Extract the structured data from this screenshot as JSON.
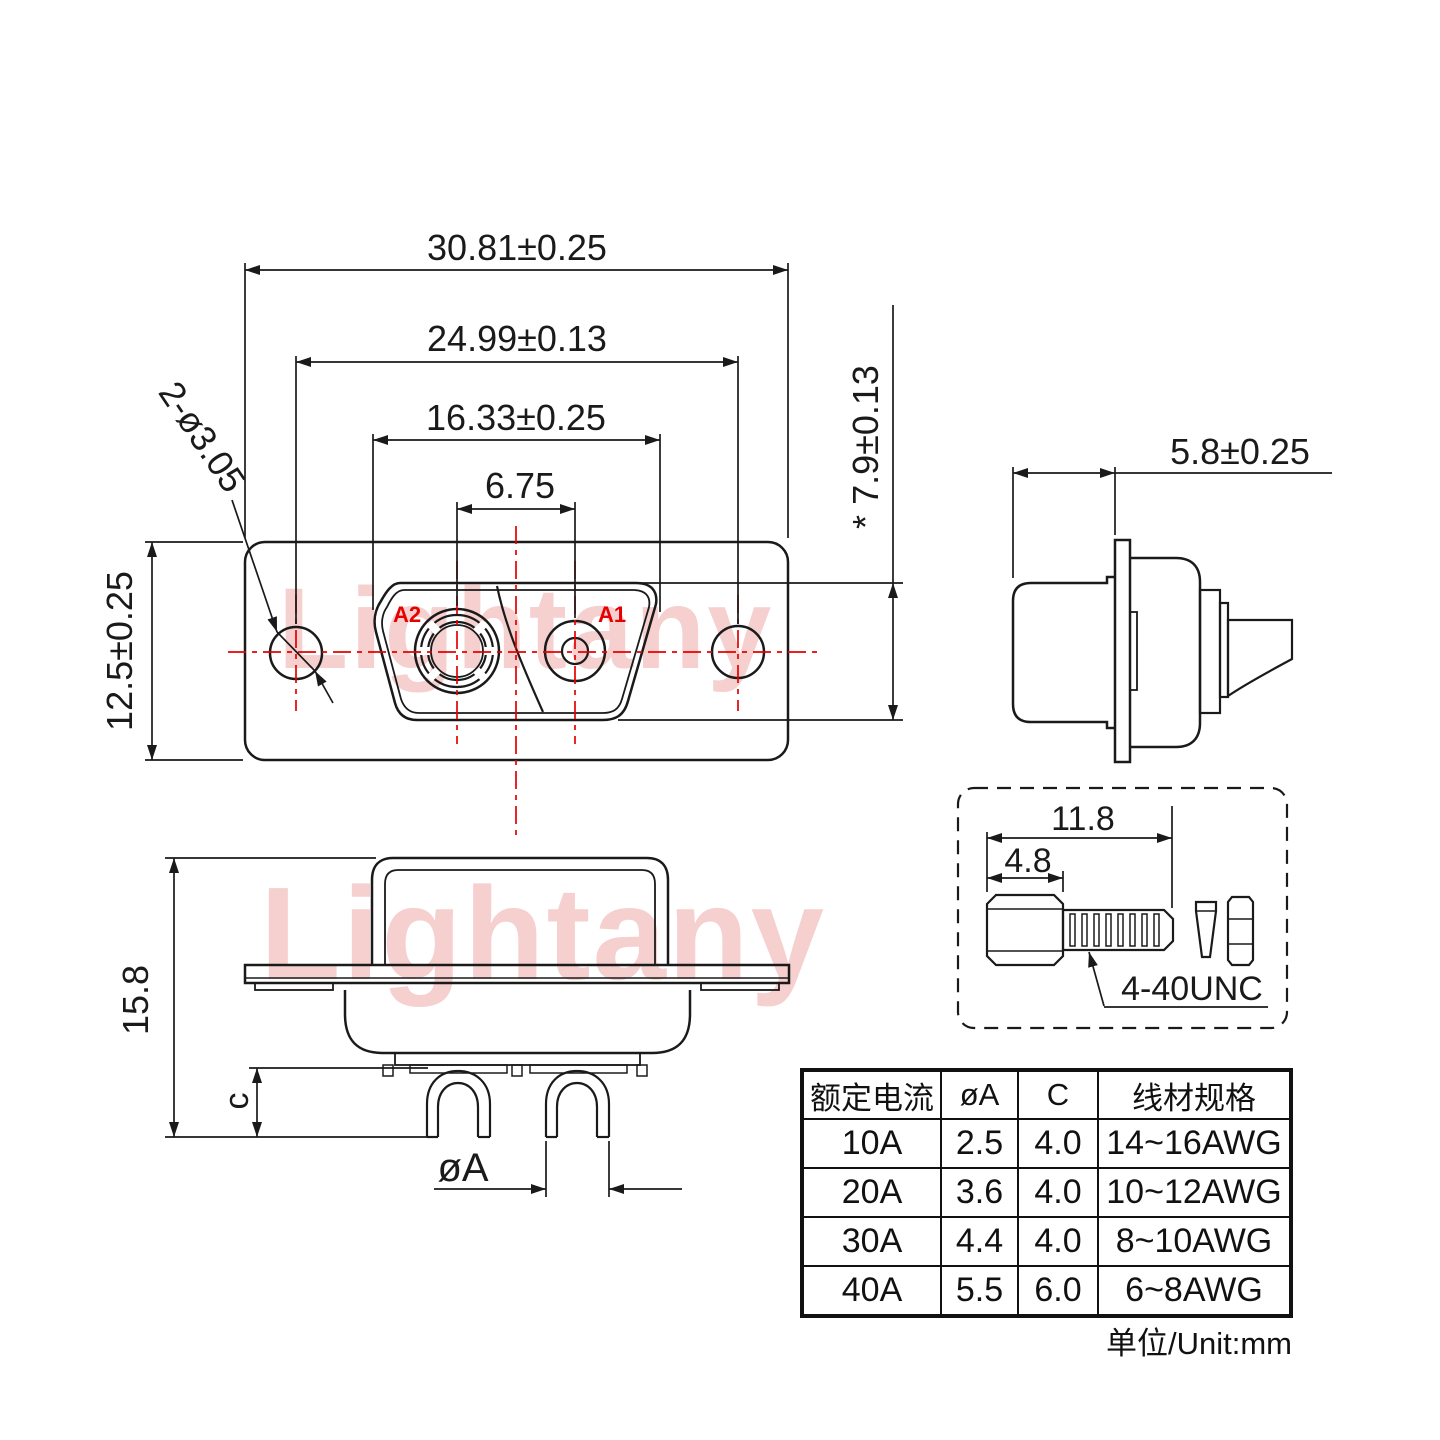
{
  "drawing": {
    "watermark": "Lightany",
    "unit_note": "单位/Unit:mm",
    "colors": {
      "line": "#1a1a1a",
      "accent_red": "#e60000",
      "watermark_pink": "#f6cfcf"
    },
    "front_view": {
      "dim_outer_width": "30.81±0.25",
      "dim_hole_pitch": "24.99±0.13",
      "dim_insert_width": "16.33±0.25",
      "dim_contact_pitch": "6.75",
      "dim_height": "12.5±0.25",
      "dim_insert_height": "* 7.9±0.13",
      "dim_mount_holes": "2-ø3.05",
      "label_a1": "A1",
      "label_a2": "A2"
    },
    "side_view": {
      "dim_depth": "5.8±0.25"
    },
    "bottom_view": {
      "dim_height": "15.8",
      "dim_cup_depth": "c",
      "dim_cup_dia": "øA"
    },
    "screw_detail": {
      "dim_length": "11.8",
      "dim_head": "4.8",
      "label_thread": "4-40UNC"
    },
    "table": {
      "headers": [
        "额定电流",
        "øA",
        "C",
        "线材规格"
      ],
      "rows": [
        {
          "current": "10A",
          "dia": "2.5",
          "c": "4.0",
          "wire": "14~16AWG"
        },
        {
          "current": "20A",
          "dia": "3.6",
          "c": "4.0",
          "wire": "10~12AWG"
        },
        {
          "current": "30A",
          "dia": "4.4",
          "c": "4.0",
          "wire": "8~10AWG"
        },
        {
          "current": "40A",
          "dia": "5.5",
          "c": "6.0",
          "wire": "6~8AWG"
        }
      ]
    }
  }
}
